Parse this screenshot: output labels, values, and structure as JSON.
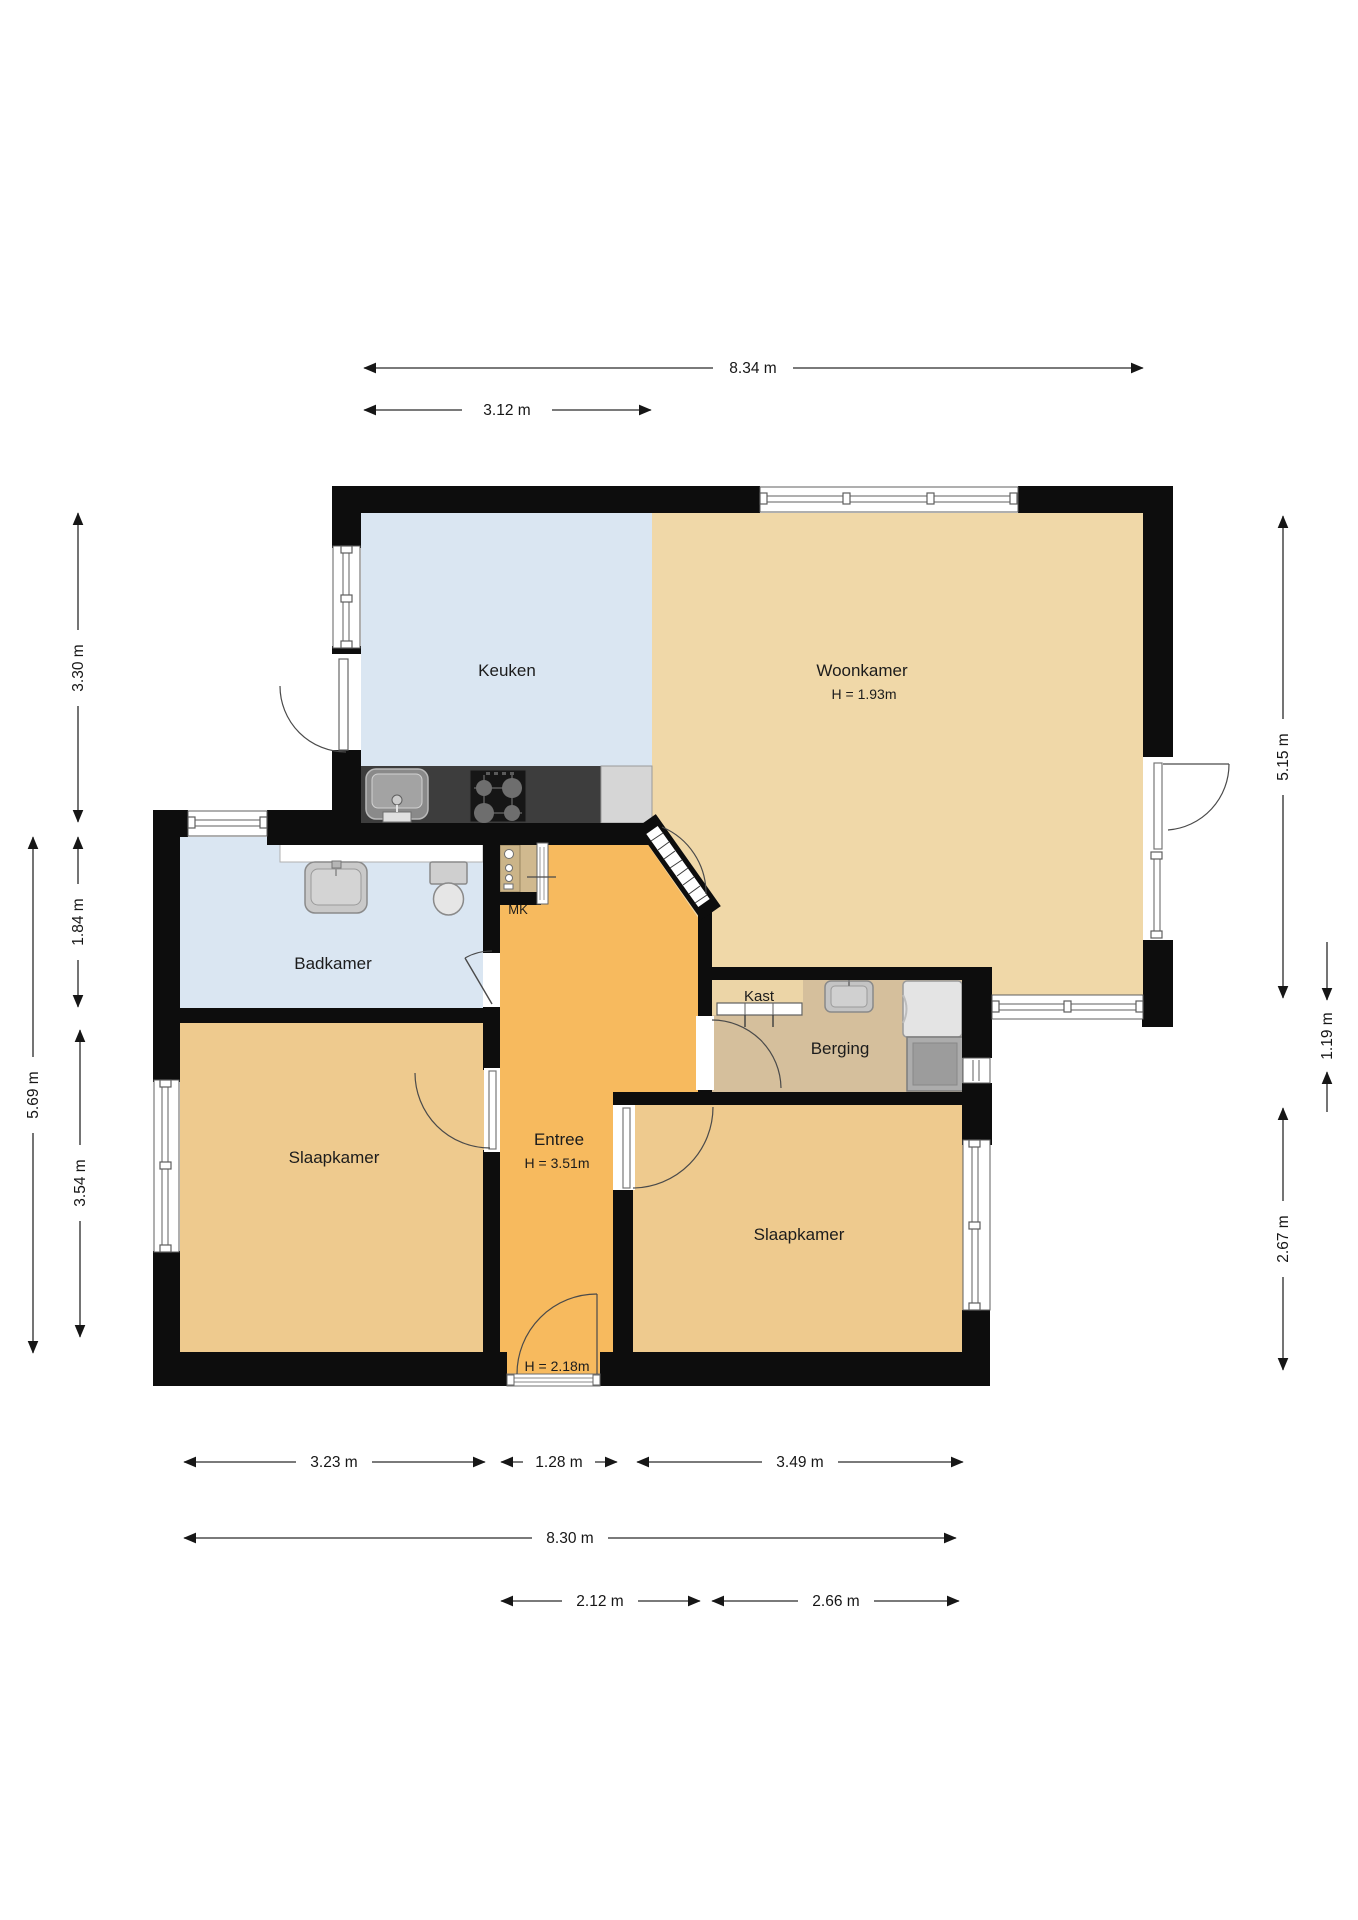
{
  "rooms": {
    "keuken": {
      "label": "Keuken"
    },
    "woonkamer": {
      "label": "Woonkamer",
      "height": "H = 1.93m"
    },
    "badkamer": {
      "label": "Badkamer"
    },
    "mk": {
      "label": "MK"
    },
    "kast": {
      "label": "Kast"
    },
    "berging": {
      "label": "Berging"
    },
    "entree": {
      "label": "Entree",
      "height": "H = 3.51m"
    },
    "slaapkamer_links": {
      "label": "Slaapkamer"
    },
    "slaapkamer_rechts": {
      "label": "Slaapkamer"
    },
    "voordeur": {
      "height": "H = 2.18m"
    }
  },
  "dimensions": {
    "top": [
      {
        "label": "8.34 m"
      },
      {
        "label": "3.12 m"
      }
    ],
    "left": [
      {
        "label": "3.30 m"
      },
      {
        "label": "1.84 m"
      },
      {
        "label": "3.54 m"
      },
      {
        "label": "5.69 m"
      }
    ],
    "right": [
      {
        "label": "5.15 m"
      },
      {
        "label": "1.19 m"
      },
      {
        "label": "2.67 m"
      }
    ],
    "bottom": [
      {
        "label": "3.23 m"
      },
      {
        "label": "1.28 m"
      },
      {
        "label": "3.49 m"
      },
      {
        "label": "8.30 m"
      },
      {
        "label": "2.12 m"
      },
      {
        "label": "2.66 m"
      }
    ]
  },
  "colors": {
    "wall": "#0d0d0d",
    "keuken": "#dae6f2",
    "badkamer": "#dae6f2",
    "woonkamer": "#f0d8a8",
    "kast": "#ecd5a7",
    "slaapkamer": "#eeca8e",
    "entree": "#f7ba5e",
    "berging": "#d5bf9c",
    "mk_floor": "#d0b98f",
    "counter_dark": "#3d3d3d",
    "counter_light": "#d6d6d6"
  }
}
